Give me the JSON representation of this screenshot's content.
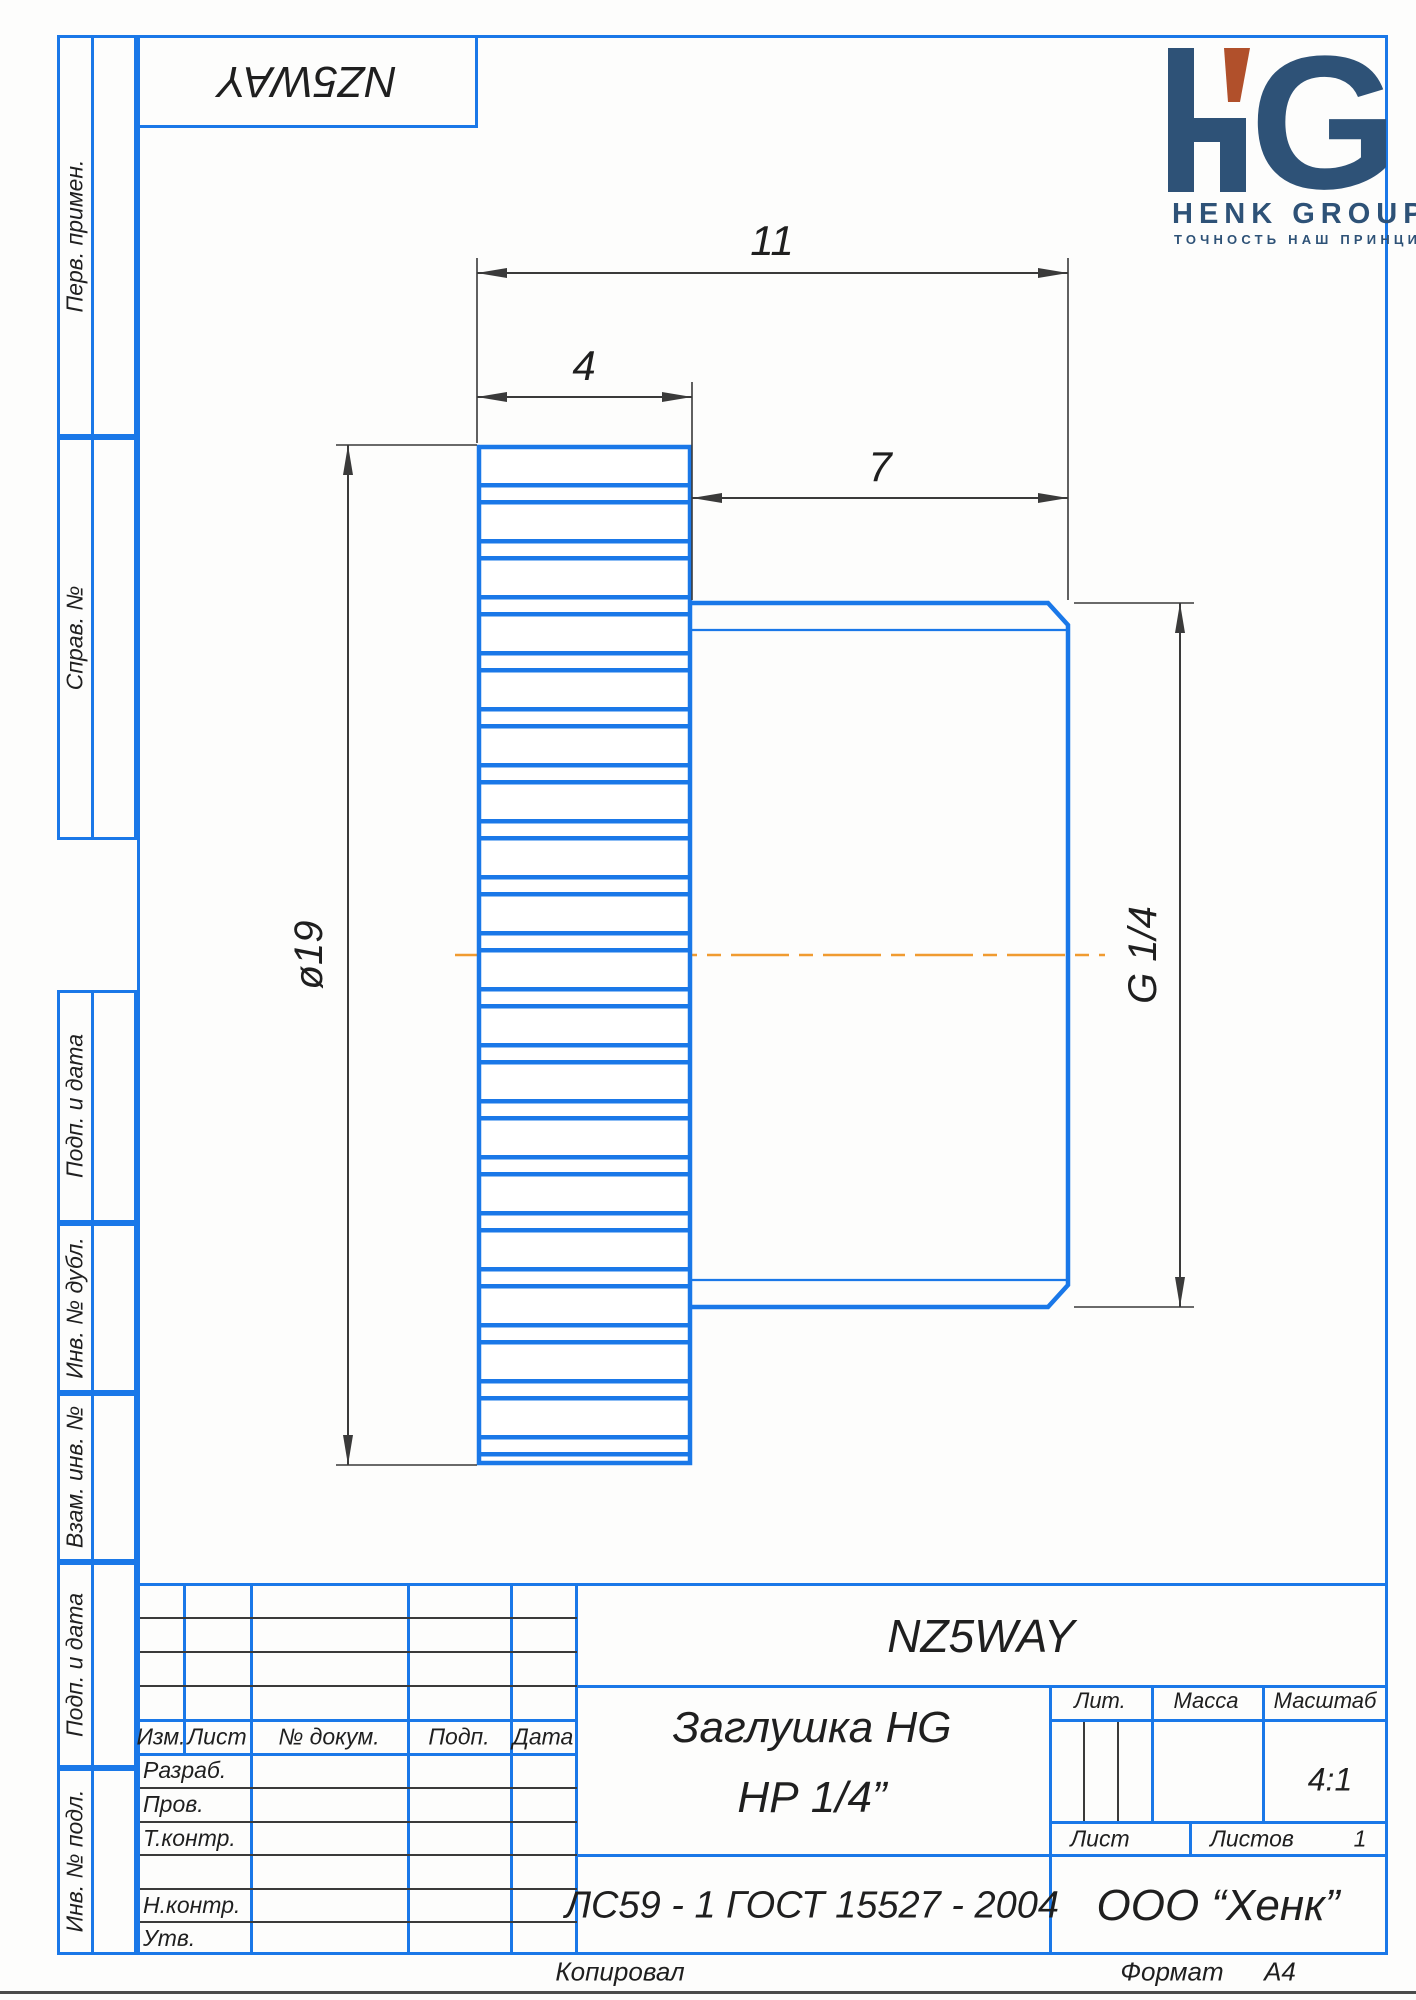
{
  "top_box": {
    "code": "NZ5WAY"
  },
  "logo": {
    "monogram_h": "H",
    "monogram_g": "G",
    "name": "HENK GROUP",
    "tagline": "ТОЧНОСТЬ НАШ ПРИНЦИП"
  },
  "side_labels": {
    "perv_primen": "Перв. примен.",
    "sprav_no": "Справ. №",
    "podp_i_data_1": "Подп. и дата",
    "inv_no_dubl": "Инв. № дубл.",
    "vzam_inv_no": "Взам. инв. №",
    "podp_i_data_2": "Подп. и дата",
    "inv_no_podl": "Инв. № подл."
  },
  "dimensions": {
    "overall_length": "11",
    "knurl_length": "4",
    "thread_length": "7",
    "head_diameter": "ø19",
    "thread_spec": "G 1/4"
  },
  "title_block": {
    "doc_code": "NZ5WAY",
    "part_name_line1": "Заглушка HG",
    "part_name_line2": "НР 1/4”",
    "material": "ЛС59 - 1 ГОСТ 15527 - 2004",
    "company": "ООО “Хенк”",
    "scale_value": "4:1",
    "sheets_value": "1",
    "labels": {
      "izm": "Изм.",
      "list": "Лист",
      "n_dokum": "№ докум.",
      "podp": "Подп.",
      "data": "Дата",
      "razrab": "Разраб.",
      "prov": "Пров.",
      "t_kontr": "Т.контр.",
      "n_kontr": "Н.контр.",
      "utv": "Утв.",
      "lit": "Лит.",
      "massa": "Масса",
      "masshtab": "Масштаб",
      "list_small": "Лист",
      "listov": "Листов"
    }
  },
  "footer": {
    "kopiroval": "Копировал",
    "format_label": "Формат",
    "format_value": "А4"
  },
  "colors": {
    "line_blue": "#1a78e8",
    "dim_line": "#3a3a3a",
    "centerline_orange": "#f09b30",
    "logo_navy": "#2e5277",
    "logo_accent": "#b1502b"
  }
}
